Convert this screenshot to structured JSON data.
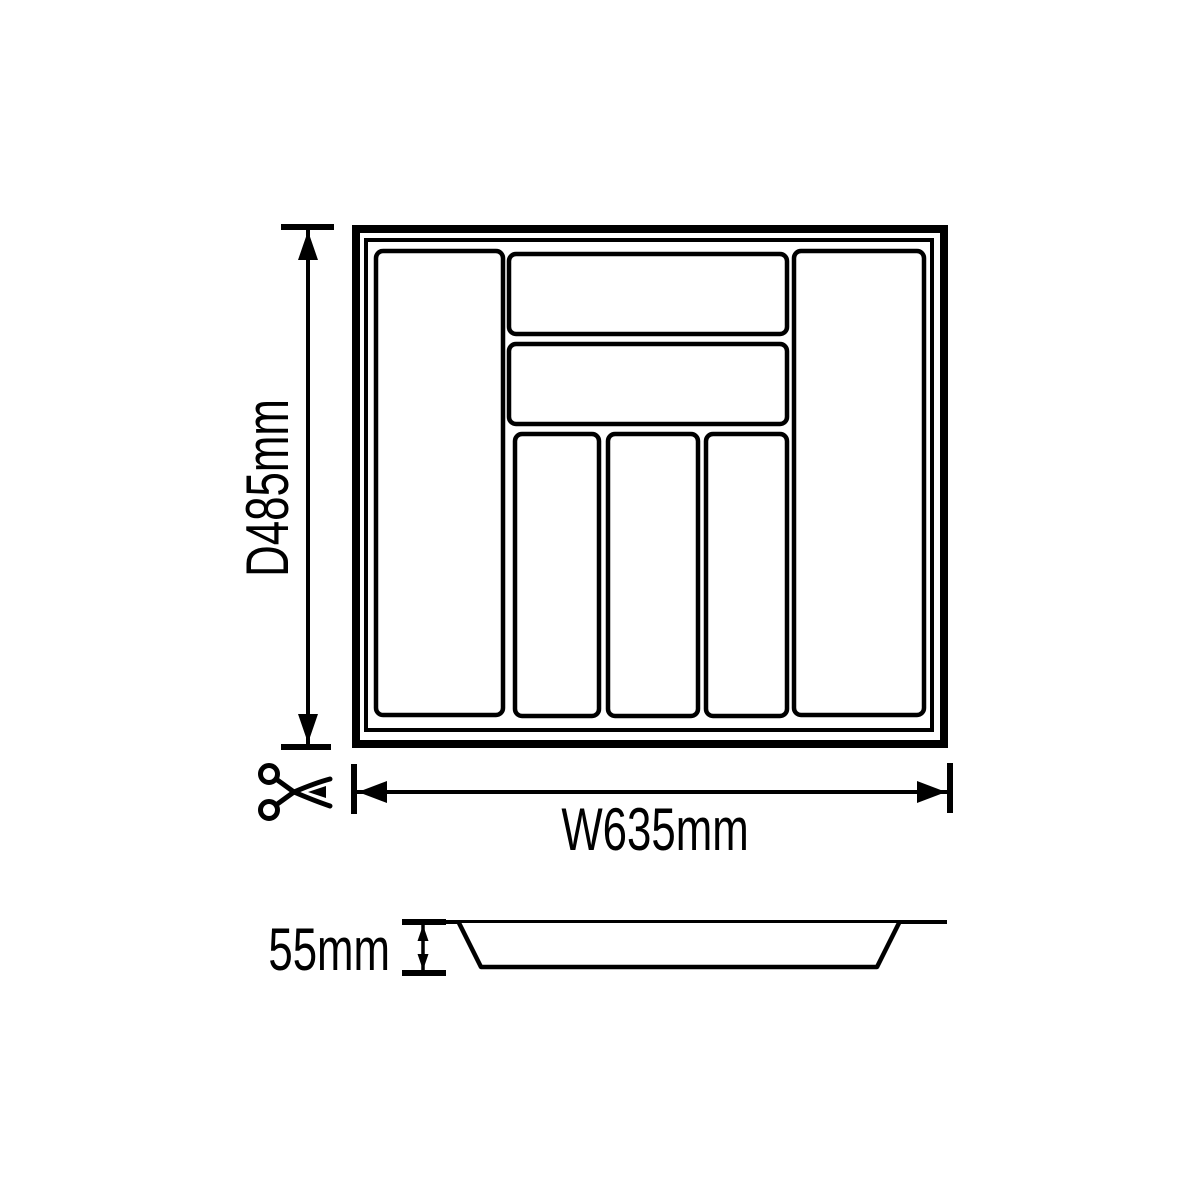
{
  "colors": {
    "ink": "#000000",
    "paper": "#ffffff"
  },
  "top_view": {
    "description": "cutlery tray insert, plan view",
    "compartment_count": 7,
    "depth_dimension": {
      "label": "D485mm"
    },
    "width_dimension": {
      "label": "W635mm"
    },
    "cut_to_size_icon": "scissors-icon"
  },
  "side_view": {
    "description": "tray cross-section profile",
    "height_dimension": {
      "label": "55mm"
    }
  }
}
